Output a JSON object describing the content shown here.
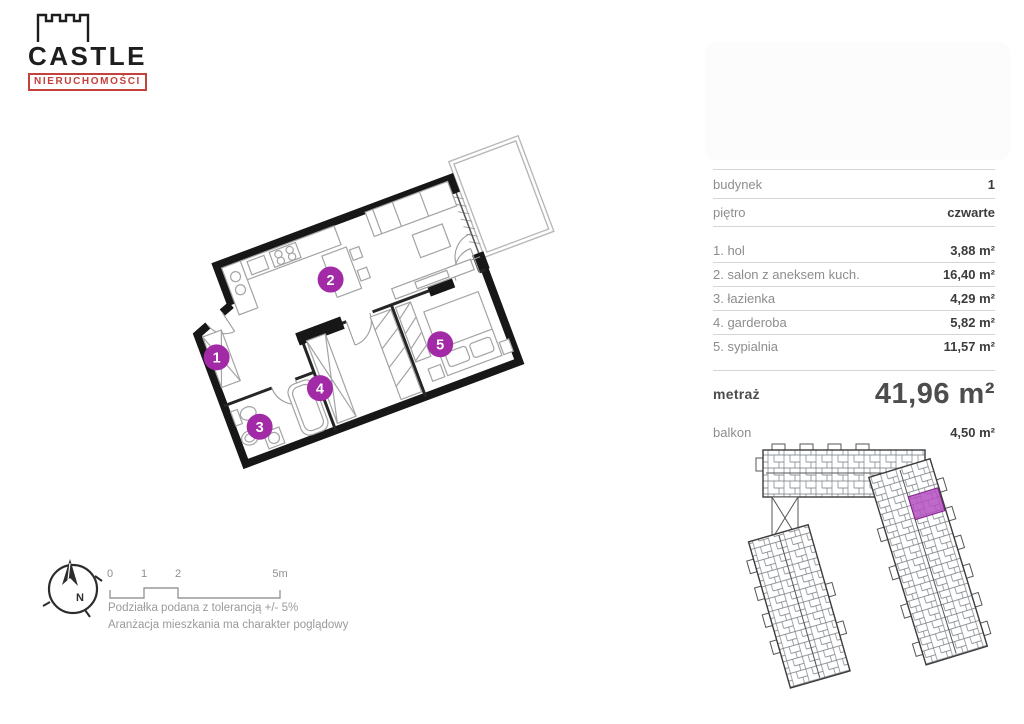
{
  "logo": {
    "title": "CASTLE",
    "subtitle": "NIERUCHOMOŚCI",
    "accent_color": "#c3423c"
  },
  "unit_table": {
    "building_label": "budynek",
    "building_value": "1",
    "floor_label": "piętro",
    "floor_value": "czwarte",
    "rooms": [
      {
        "name": "1. hol",
        "area": "3,88 m²"
      },
      {
        "name": "2. salon z aneksem kuch.",
        "area": "16,40 m²"
      },
      {
        "name": "3. łazienka",
        "area": "4,29 m²"
      },
      {
        "name": "4. garderoba",
        "area": "5,82 m²"
      },
      {
        "name": "5. sypialnia",
        "area": "11,57 m²"
      }
    ],
    "total_label": "metraż",
    "total_value": "41,96 m²",
    "balcony_label": "balkon",
    "balcony_value": "4,50 m²"
  },
  "floor_plan": {
    "badges": [
      "1",
      "2",
      "3",
      "4",
      "5"
    ],
    "badge_color": "#a32aa6"
  },
  "compass": {
    "north_label": "N"
  },
  "scale_bar": {
    "tick_0": "0",
    "tick_1": "1",
    "tick_2": "2",
    "tick_5": "5m"
  },
  "notes": {
    "line1": "Podziałka podana z tolerancją +/- 5%",
    "line2": "Aranżacja mieszkania ma charakter poglądowy"
  },
  "site_plan": {
    "highlight_color": "#b44fc1"
  }
}
